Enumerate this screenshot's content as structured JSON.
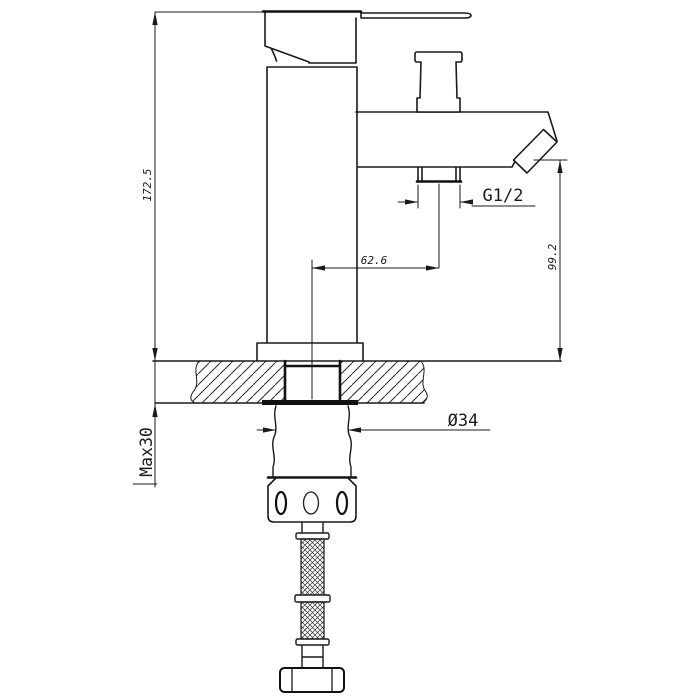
{
  "drawing": {
    "labels": {
      "overall_height": "172.5",
      "max_counter_thickness": "Max30",
      "spout_center_offset": "62.6",
      "spout_outlet_height": "99.2",
      "shower_hose_thread": "G1/2",
      "mounting_hole_diameter": "Ø34"
    }
  }
}
